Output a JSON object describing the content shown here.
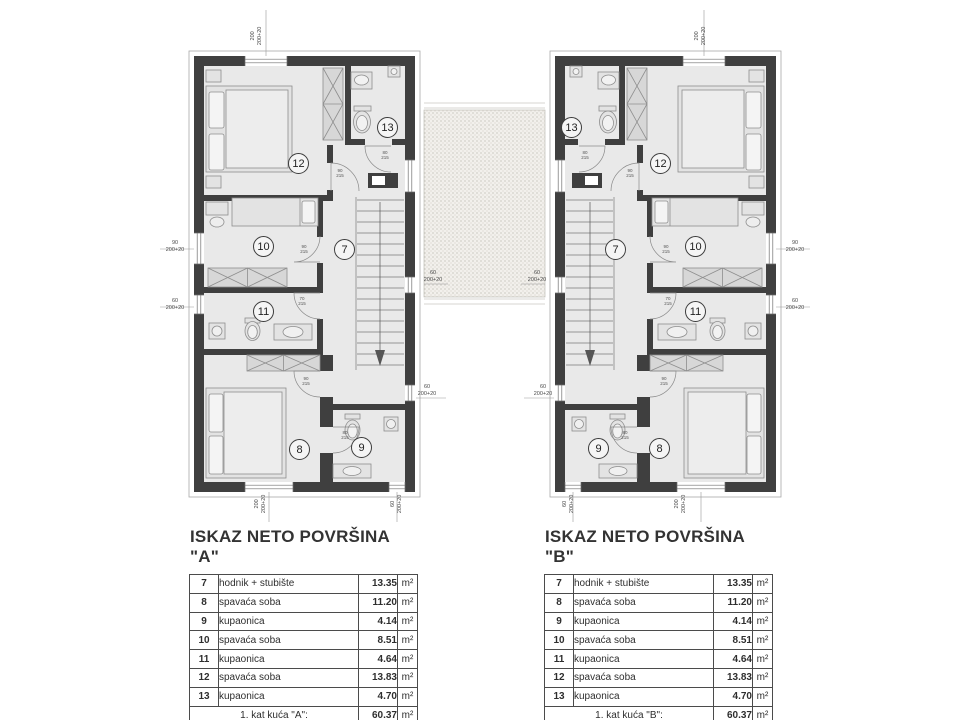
{
  "tables": {
    "unit": "m²",
    "a": {
      "title": "ISKAZ NETO POVRŠINA \"A\"",
      "rows": [
        {
          "num": "7",
          "name": "hodnik + stubište",
          "value": "13.35"
        },
        {
          "num": "8",
          "name": "spavaća soba",
          "value": "11.20"
        },
        {
          "num": "9",
          "name": "kupaonica",
          "value": "4.14"
        },
        {
          "num": "10",
          "name": "spavaća soba",
          "value": "8.51"
        },
        {
          "num": "11",
          "name": "kupaonica",
          "value": "4.64"
        },
        {
          "num": "12",
          "name": "spavaća soba",
          "value": "13.83"
        },
        {
          "num": "13",
          "name": "kupaonica",
          "value": "4.70"
        }
      ],
      "total_label": "1. kat kuća \"A\":",
      "total_value": "60.37"
    },
    "b": {
      "title": "ISKAZ NETO POVRŠINA \"B\"",
      "rows": [
        {
          "num": "7",
          "name": "hodnik + stubište",
          "value": "13.35"
        },
        {
          "num": "8",
          "name": "spavaća soba",
          "value": "11.20"
        },
        {
          "num": "9",
          "name": "kupaonica",
          "value": "4.14"
        },
        {
          "num": "10",
          "name": "spavaća soba",
          "value": "8.51"
        },
        {
          "num": "11",
          "name": "kupaonica",
          "value": "4.64"
        },
        {
          "num": "12",
          "name": "spavaća soba",
          "value": "13.83"
        },
        {
          "num": "13",
          "name": "kupaonica",
          "value": "4.70"
        }
      ],
      "total_label": "1. kat kuća \"B\":",
      "total_value": "60.37"
    }
  },
  "plans": {
    "a": {
      "rooms": [
        "12",
        "13",
        "7",
        "10",
        "11",
        "8",
        "9"
      ],
      "dims": [
        "200\n200+20",
        "90\n200+20",
        "60\n200+20",
        "200\n200+20",
        "60\n200+20",
        "60\n200+20",
        "60\n200+20"
      ],
      "doors": [
        "80\n215",
        "90\n215",
        "90\n215",
        "70\n215",
        "90\n215",
        "80\n215"
      ]
    },
    "b": {
      "rooms": [
        "12",
        "13",
        "7",
        "10",
        "11",
        "8",
        "9"
      ],
      "dims": [
        "200\n200+20",
        "90\n200+20",
        "60\n200+20",
        "200\n200+20",
        "60\n200+20",
        "60\n200+20",
        "60\n200+20"
      ],
      "doors": [
        "80\n215",
        "90\n215",
        "90\n215",
        "70\n215",
        "90\n215",
        "80\n215"
      ]
    }
  },
  "colors": {
    "wall": "#3f3f3f",
    "floor": "#e9e9e9",
    "terrace_bg": "#f2f0ec",
    "table_border": "#4b4b4b"
  }
}
